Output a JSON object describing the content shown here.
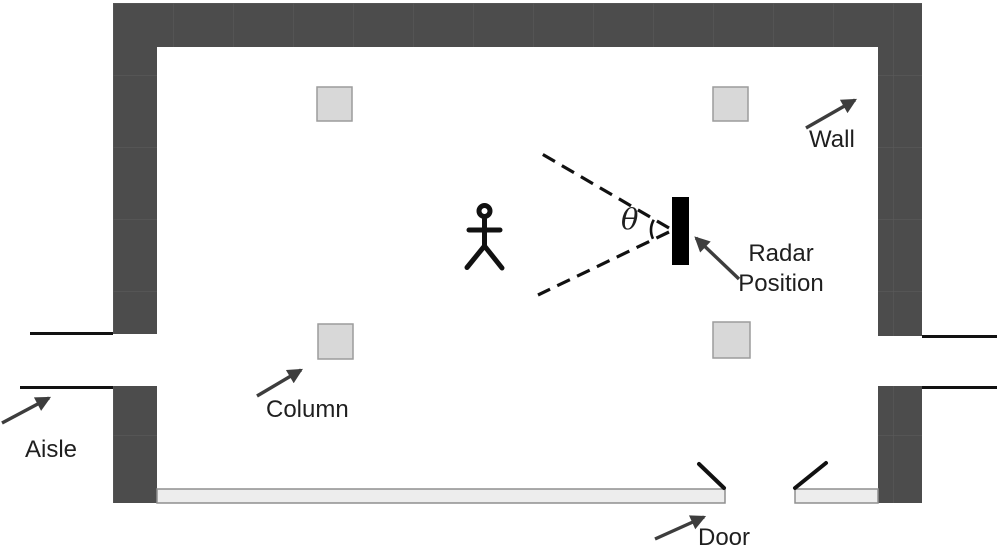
{
  "figure": {
    "labels": {
      "wall": "Wall",
      "radar_position": "Radar Position",
      "column": "Column",
      "aisle": "Aisle",
      "door": "Door",
      "theta": "θ"
    },
    "colors": {
      "background": "#ffffff",
      "wall_fill": "#4c4c4c",
      "wall_seam": "#5a5a5a",
      "column_fill": "#d8d8d8",
      "column_stroke": "#9c9c9c",
      "glass_wall_fill": "#ededed",
      "glass_wall_stroke": "#8f8f8f",
      "radar_fill": "#000000",
      "line_color": "#111111",
      "arrow_color": "#3d3d3d",
      "text_color": "#1f1f1f"
    }
  }
}
